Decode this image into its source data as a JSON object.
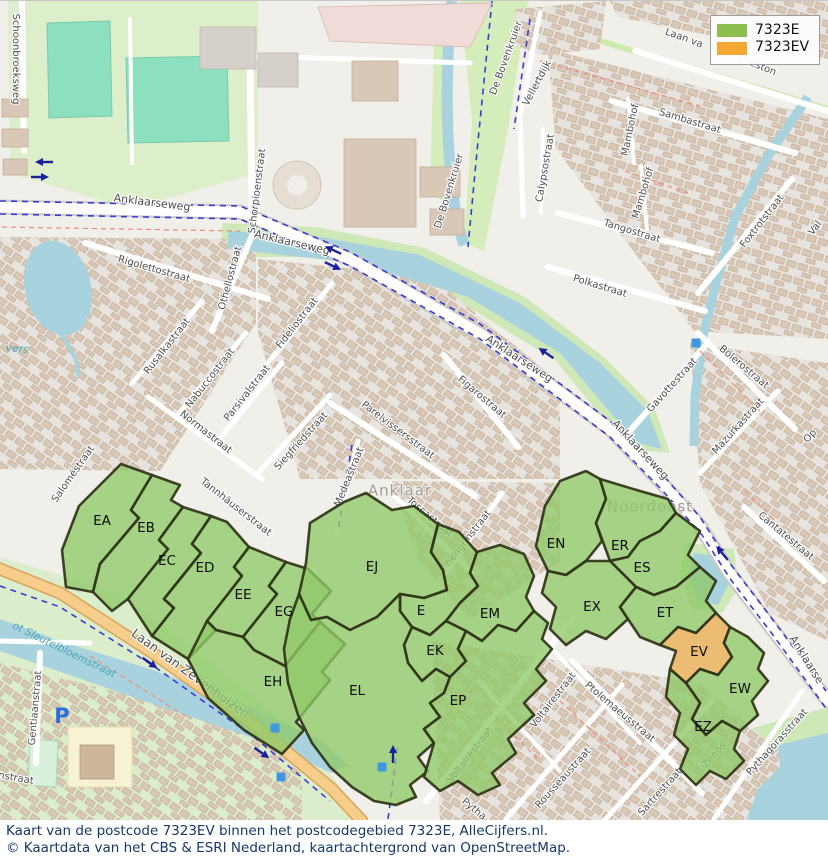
{
  "legend": {
    "items": [
      {
        "label": "7323E",
        "color": "#8CBF4F"
      },
      {
        "label": "7323EV",
        "color": "#F5A733"
      }
    ]
  },
  "captions": {
    "line1": "Kaart van de postcode 7323EV binnen het postcodegebied 7323E, AlleCijfers.nl.",
    "line2": "© Kaartdata van het CBS & ESRI Nederland, kaartachtergrond van OpenStreetMap."
  },
  "map_colors": {
    "area_fill": "#8fc968",
    "area_highlight_fill": "#e9ad4f",
    "area_border": "#2f3317",
    "parking_icon": "#2a6fdb",
    "poi_icon": "#3f97e0",
    "route_arrow": "#1a1f9e"
  },
  "areas": [
    {
      "code": "EA",
      "group": "7323E",
      "label": [
        102,
        520
      ],
      "points": "66,586 62,549 79,505 121,463 152,474 131,509 139,517 100,563 93,591"
    },
    {
      "code": "EB",
      "group": "7323E",
      "label": [
        146,
        527
      ],
      "points": "152,474 180,484 171,499 183,506 159,539 168,548 128,598 112,610 93,591 100,563 139,517 131,509"
    },
    {
      "code": "EC",
      "group": "7323E",
      "label": [
        167,
        560
      ],
      "points": "183,506 211,515 192,543 201,552 164,598 174,607 152,635 128,598 168,548 159,539"
    },
    {
      "code": "ED",
      "group": "7323E",
      "label": [
        205,
        567
      ],
      "points": "211,515 227,521 249,546 234,566 242,575 207,620 216,629 188,658 152,635 174,607 164,598 201,552 192,543"
    },
    {
      "code": "EE",
      "group": "7323E",
      "label": [
        243,
        594
      ],
      "points": "249,546 286,561 269,585 277,593 243,636 216,629 207,620 242,575 234,566"
    },
    {
      "code": "EG",
      "group": "7323E",
      "label": [
        284,
        611
      ],
      "points": "286,561 308,568 331,590 312,613 320,621 285,665 254,649 243,636 277,593 269,585"
    },
    {
      "code": "EH",
      "group": "7323E",
      "label": [
        273,
        681
      ],
      "points": "188,658 207,620 216,629 243,636 254,649 285,665 320,621 345,643 322,671 330,679 296,721 304,729 282,753 244,729 208,697"
    },
    {
      "code": "EJ",
      "group": "7323E",
      "label": [
        372,
        566
      ],
      "points": "306,562 310,522 344,501 366,492 392,509 414,505 438,523 431,551 443,569 447,589 424,597 400,593 377,616 350,629 327,616 311,619 299,593"
    },
    {
      "code": "E",
      "group": "7323E",
      "label": [
        421,
        610
      ],
      "points": "438,523 459,531 477,551 470,572 478,585 460,602 446,620 430,634 412,626 400,610 400,593 424,597 447,589 443,569 431,551"
    },
    {
      "code": "EM",
      "group": "7323E",
      "label": [
        490,
        613
      ],
      "points": "477,551 500,544 524,553 534,575 526,596 534,610 516,630 498,624 482,640 466,630 446,620 460,602 478,585 470,572"
    },
    {
      "code": "EK",
      "group": "7323E",
      "label": [
        435,
        650
      ],
      "points": "412,626 430,634 446,620 466,630 458,648 466,660 450,676 436,668 422,680 408,662 404,644"
    },
    {
      "code": "EL",
      "group": "7323E",
      "label": [
        357,
        690
      ],
      "points": "299,593 311,619 327,616 350,629 377,616 400,593 400,610 412,626 404,644 408,662 422,680 436,668 450,676 444,692 430,702 440,716 424,728 434,742 418,756 428,770 410,784 416,796 396,804 374,800 352,786 330,766 312,742 298,714 288,682 284,648 290,618"
    },
    {
      "code": "EP",
      "group": "7323E",
      "label": [
        458,
        700
      ],
      "points": "458,648 466,630 482,640 498,624 516,630 534,610 548,622 542,638 552,648 536,668 546,680 524,702 534,714 508,738 516,752 492,772 500,784 478,794 458,780 440,790 424,776 434,742 424,728 440,716 430,702 444,692 450,676 466,660"
    },
    {
      "code": "EN",
      "group": "7323E",
      "label": [
        556,
        543
      ],
      "points": "536,545 545,505 560,480 586,470 600,478 606,498 596,522 602,540 586,560 566,574 548,570"
    },
    {
      "code": "ER",
      "group": "7323E",
      "label": [
        620,
        545
      ],
      "points": "600,478 640,490 668,498 676,512 660,530 640,540 628,556 610,560 596,522 606,498"
    },
    {
      "code": "ES",
      "group": "7323E",
      "label": [
        642,
        567
      ],
      "points": "610,560 628,556 640,540 660,530 676,512 700,530 688,554 700,566 676,586 654,594 636,586"
    },
    {
      "code": "EX",
      "group": "7323E",
      "label": [
        592,
        606
      ],
      "points": "548,570 566,574 586,560 610,560 636,586 620,606 628,618 606,638 586,630 566,644 550,628 556,606 542,592"
    },
    {
      "code": "ET",
      "group": "7323E",
      "label": [
        665,
        612
      ],
      "points": "636,586 654,594 676,586 700,566 716,580 706,600 716,612 696,632 678,626 660,644 640,636 628,618 620,606"
    },
    {
      "code": "EV",
      "group": "7323EV",
      "label": [
        699,
        651
      ],
      "points": "678,626 696,632 716,612 730,626 724,642 732,656 718,674 700,668 686,682 670,668 676,650 660,644"
    },
    {
      "code": "EW",
      "group": "7323E",
      "label": [
        740,
        688
      ],
      "points": "730,626 748,636 764,652 758,668 768,680 752,700 758,714 740,730 722,720 706,734 692,718 700,702 686,682 700,668 718,674 732,656 724,642"
    },
    {
      "code": "EZ",
      "group": "7323E",
      "label": [
        703,
        726
      ],
      "points": "670,668 686,682 700,702 692,718 706,734 722,720 740,730 734,748 744,760 726,778 710,770 696,784 680,768 688,748 674,734 680,712 666,696"
    }
  ],
  "street_labels": [
    {
      "t": "Schoonbroeksweg",
      "x": 16,
      "y": 58,
      "r": 90
    },
    {
      "t": "Anklaarseweg",
      "x": 152,
      "y": 202,
      "r": 7,
      "s": 11
    },
    {
      "t": "Anklaarseweg",
      "x": 292,
      "y": 242,
      "r": 13,
      "s": 11
    },
    {
      "t": "Schorpioenstraat",
      "x": 257,
      "y": 190,
      "r": -83
    },
    {
      "t": "De Bovenkruier",
      "x": 506,
      "y": 57,
      "r": -70
    },
    {
      "t": "De Bovenkruier",
      "x": 449,
      "y": 190,
      "r": -73
    },
    {
      "t": "Vellertdijk",
      "x": 537,
      "y": 82,
      "r": -62
    },
    {
      "t": "Calypsostraat",
      "x": 545,
      "y": 167,
      "r": -80
    },
    {
      "t": "Laan va",
      "x": 684,
      "y": 37,
      "r": 20
    },
    {
      "t": "arleston",
      "x": 757,
      "y": 64,
      "r": 22
    },
    {
      "t": "Sambastraat",
      "x": 690,
      "y": 120,
      "r": 17
    },
    {
      "t": "Mambohof",
      "x": 630,
      "y": 129,
      "r": -78
    },
    {
      "t": "Mambohof",
      "x": 643,
      "y": 192,
      "r": -73
    },
    {
      "t": "Tangostraat",
      "x": 632,
      "y": 230,
      "r": 17
    },
    {
      "t": "Polkastraat",
      "x": 600,
      "y": 285,
      "r": 17
    },
    {
      "t": "Foxtrotstraat",
      "x": 762,
      "y": 220,
      "r": -52
    },
    {
      "t": "Val",
      "x": 815,
      "y": 227,
      "r": -52
    },
    {
      "t": "Rigolettostraat",
      "x": 154,
      "y": 268,
      "r": 16
    },
    {
      "t": "Othellostraat",
      "x": 230,
      "y": 277,
      "r": -75
    },
    {
      "t": "Rusalkastraat",
      "x": 167,
      "y": 345,
      "r": -52
    },
    {
      "t": "Nabuccostraat",
      "x": 210,
      "y": 377,
      "r": -52
    },
    {
      "t": "Parsivalstraat",
      "x": 247,
      "y": 392,
      "r": -52
    },
    {
      "t": "Normastraat",
      "x": 206,
      "y": 431,
      "r": 38
    },
    {
      "t": "Fideliostraat",
      "x": 297,
      "y": 322,
      "r": -52
    },
    {
      "t": "Anklaarseweg",
      "x": 519,
      "y": 358,
      "r": 33,
      "s": 11
    },
    {
      "t": "Figarostraat",
      "x": 482,
      "y": 396,
      "r": 40
    },
    {
      "t": "Parelvissersstraat",
      "x": 398,
      "y": 429,
      "r": 37
    },
    {
      "t": "Siegfriedstraat",
      "x": 301,
      "y": 440,
      "r": -48
    },
    {
      "t": "Medeastraat",
      "x": 349,
      "y": 476,
      "r": -68
    },
    {
      "t": "Toscastraat",
      "x": 430,
      "y": 516,
      "r": 40
    },
    {
      "t": "hengrinstraat",
      "x": 468,
      "y": 537,
      "r": -52
    },
    {
      "t": "Gavottestraat",
      "x": 672,
      "y": 384,
      "r": -48
    },
    {
      "t": "Bolerostraat",
      "x": 744,
      "y": 366,
      "r": 40
    },
    {
      "t": "Mazurkastraat",
      "x": 738,
      "y": 425,
      "r": -48
    },
    {
      "t": "Anklaarseweg",
      "x": 640,
      "y": 449,
      "r": 47,
      "s": 11
    },
    {
      "t": "Cantatestraat",
      "x": 786,
      "y": 535,
      "r": 40
    },
    {
      "t": "Op",
      "x": 810,
      "y": 435,
      "r": -48
    },
    {
      "t": "Voltairestraat",
      "x": 470,
      "y": 754,
      "r": -52
    },
    {
      "t": "Voltairestraat",
      "x": 553,
      "y": 699,
      "r": -52
    },
    {
      "t": "Ptolemaeusstraat",
      "x": 620,
      "y": 711,
      "r": 40
    },
    {
      "t": "Rousseaustraat",
      "x": 563,
      "y": 777,
      "r": -48
    },
    {
      "t": "Sartrestraat",
      "x": 660,
      "y": 791,
      "r": -48
    },
    {
      "t": "Zenos",
      "x": 714,
      "y": 754,
      "r": -48
    },
    {
      "t": "Pythagorasstraat",
      "x": 777,
      "y": 741,
      "r": -48
    },
    {
      "t": "Pytha",
      "x": 474,
      "y": 808,
      "r": 40
    },
    {
      "t": "Anklaarse",
      "x": 806,
      "y": 659,
      "r": 58,
      "s": 11
    },
    {
      "t": "Laan van Zevenhuizen",
      "x": 190,
      "y": 673,
      "r": 36,
      "s": 12.5
    },
    {
      "t": "Gentiaanstraat",
      "x": 35,
      "y": 707,
      "r": -85
    },
    {
      "t": "nstraat",
      "x": 16,
      "y": 777,
      "r": 10
    },
    {
      "t": "Tannhäuserstraat",
      "x": 236,
      "y": 506,
      "r": 38
    },
    {
      "t": "Saloméstraat",
      "x": 73,
      "y": 473,
      "r": -55
    },
    {
      "t": "ot Sleutelbloemstraat",
      "x": 64,
      "y": 649,
      "r": 26,
      "type": "water"
    },
    {
      "t": "vers",
      "x": 17,
      "y": 348,
      "r": 5,
      "type": "water"
    },
    {
      "t": "Anklaar",
      "x": 400,
      "y": 490,
      "r": 0,
      "type": "place"
    },
    {
      "t": "Noordoost",
      "x": 650,
      "y": 506,
      "r": 0,
      "type": "place"
    }
  ],
  "icons": [
    {
      "kind": "parking",
      "glyph": "P",
      "x": 62,
      "y": 716
    },
    {
      "kind": "poi",
      "x": 696,
      "y": 342
    },
    {
      "kind": "poi",
      "x": 275,
      "y": 727
    },
    {
      "kind": "poi",
      "x": 281,
      "y": 776
    },
    {
      "kind": "poi",
      "x": 382,
      "y": 766
    }
  ],
  "route_arrows": [
    {
      "x": 44,
      "y": 161,
      "r": 180
    },
    {
      "x": 40,
      "y": 176,
      "r": 0
    },
    {
      "x": 333,
      "y": 249,
      "r": 205
    },
    {
      "x": 333,
      "y": 265,
      "r": 25
    },
    {
      "x": 546,
      "y": 352,
      "r": 215
    },
    {
      "x": 722,
      "y": 552,
      "r": 230
    },
    {
      "x": 150,
      "y": 662,
      "r": 35
    },
    {
      "x": 262,
      "y": 752,
      "r": 35
    },
    {
      "x": 393,
      "y": 753,
      "r": 270
    }
  ]
}
